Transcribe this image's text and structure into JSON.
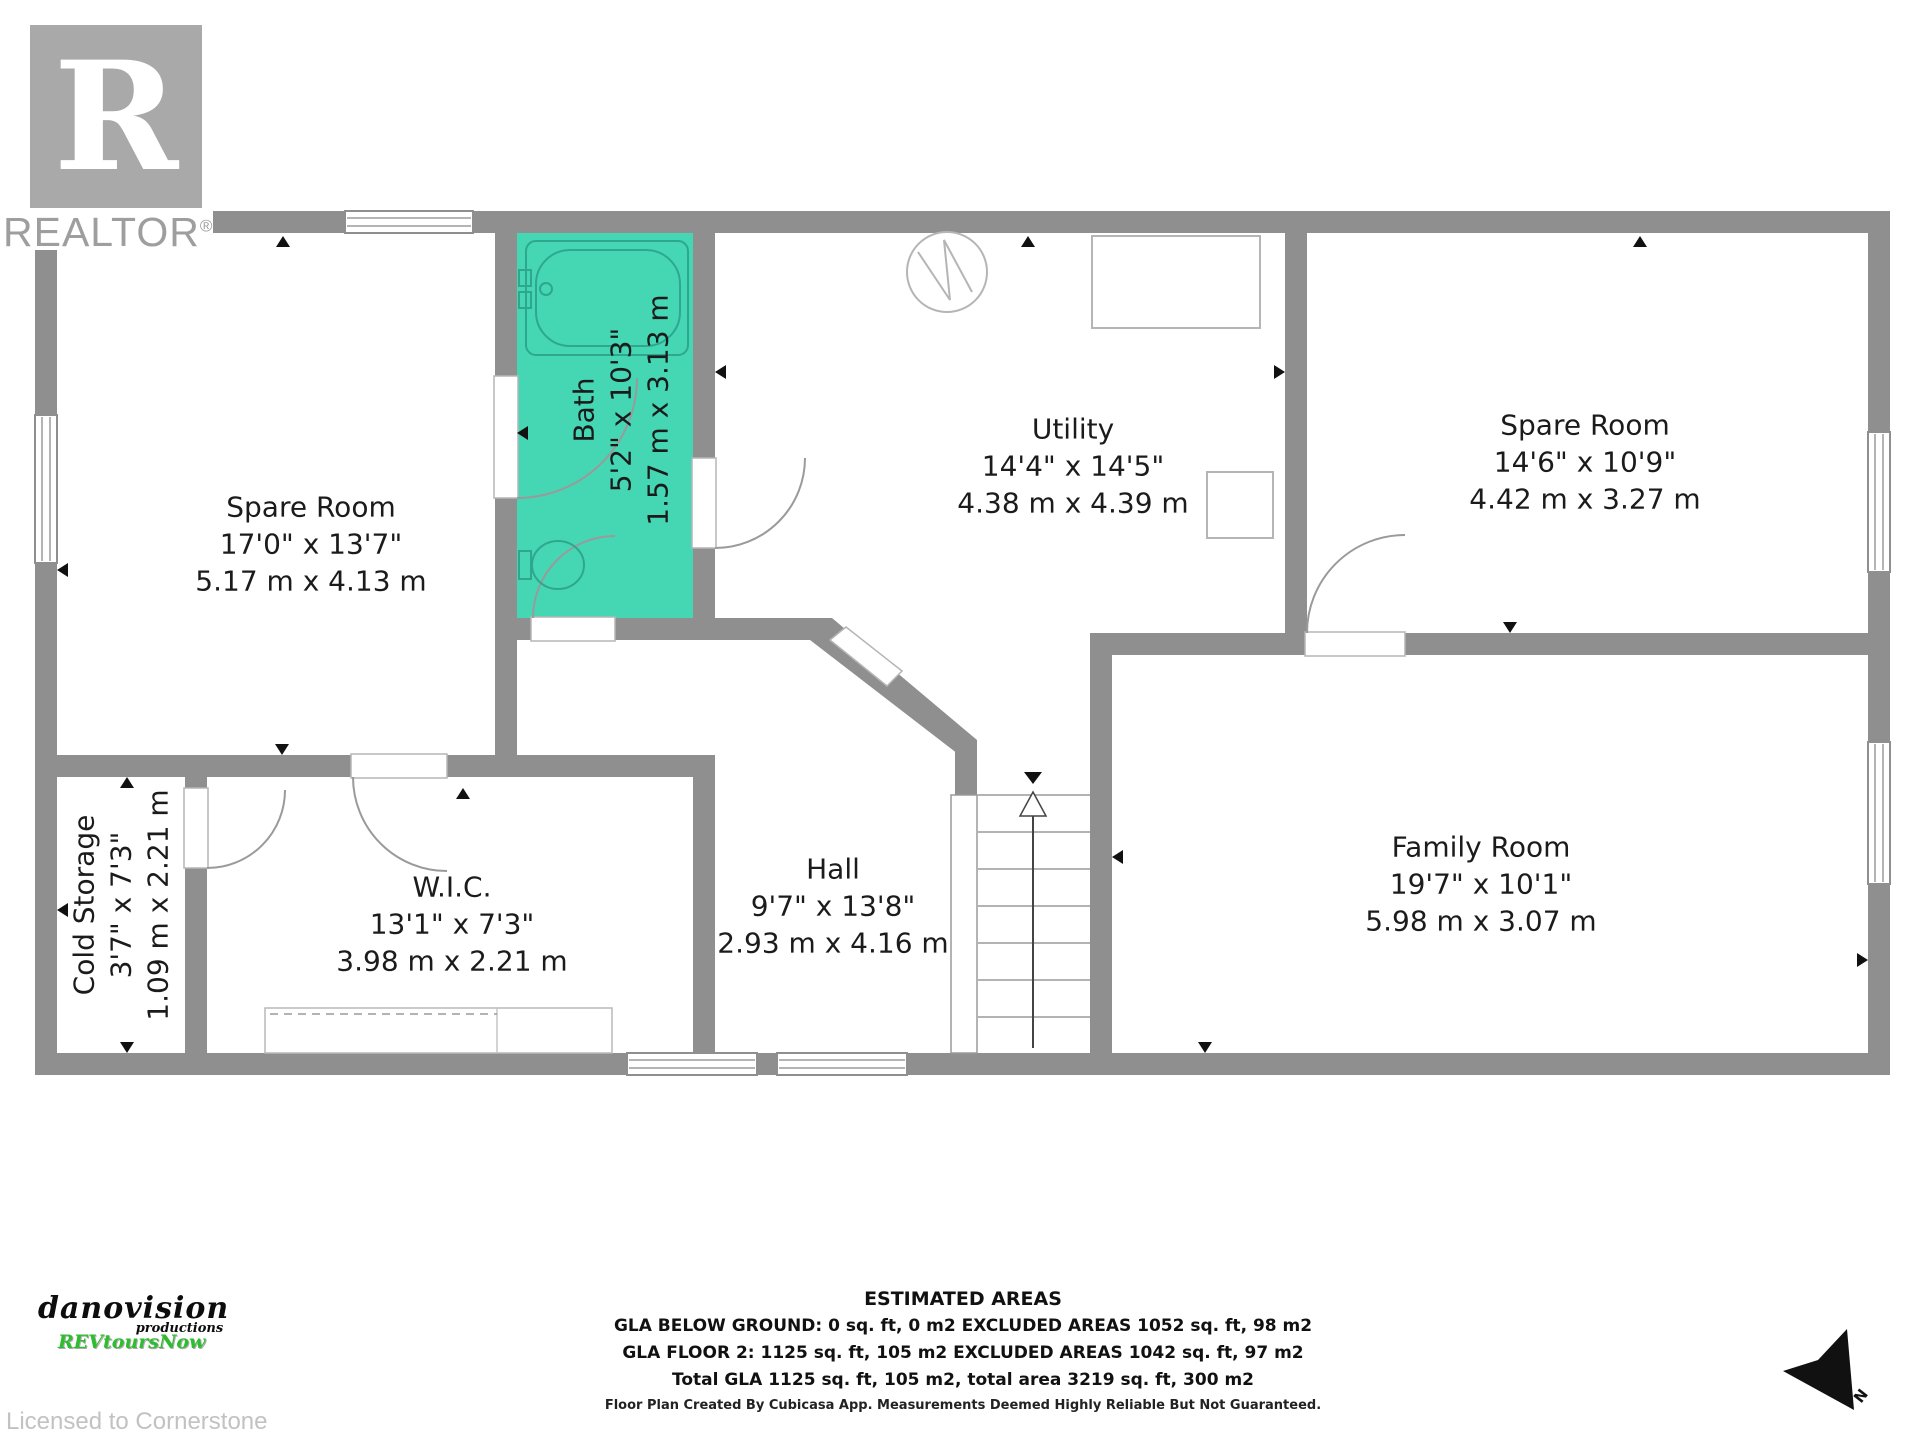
{
  "branding": {
    "logo_letter": "R",
    "realtor_text": "REALTOR",
    "reg_mark": "®",
    "producer_line1": "danovision",
    "producer_line2": "productions",
    "producer_line3": "REVtoursNow",
    "licensed_text": "Licensed to Cornerstone"
  },
  "colors": {
    "wall_grey": "#8f8f8f",
    "bath_teal": "#45d6b4",
    "logo_grey": "#a9a9a9",
    "producer_green": "#2ebd2e",
    "text_black": "#1b1b1b"
  },
  "rooms": [
    {
      "id": "spare-room-left",
      "name": "Spare Room",
      "imperial": "17'0\" x 13'7\"",
      "metric": "5.17 m x 4.13 m"
    },
    {
      "id": "bath",
      "name": "Bath",
      "imperial": "5'2\" x 10'3\"",
      "metric": "1.57 m x 3.13 m"
    },
    {
      "id": "utility",
      "name": "Utility",
      "imperial": "14'4\" x 14'5\"",
      "metric": "4.38 m x 4.39 m"
    },
    {
      "id": "spare-room-right",
      "name": "Spare Room",
      "imperial": "14'6\" x 10'9\"",
      "metric": "4.42 m x 3.27 m"
    },
    {
      "id": "cold-storage",
      "name": "Cold Storage",
      "imperial": "3'7\" x 7'3\"",
      "metric": "1.09 m x 2.21 m"
    },
    {
      "id": "wic",
      "name": "W.I.C.",
      "imperial": "13'1\" x 7'3\"",
      "metric": "3.98 m x 2.21 m"
    },
    {
      "id": "hall",
      "name": "Hall",
      "imperial": "9'7\" x 13'8\"",
      "metric": "2.93 m x 4.16 m"
    },
    {
      "id": "family-room",
      "name": "Family Room",
      "imperial": "19'7\" x 10'1\"",
      "metric": "5.98 m x 3.07 m"
    }
  ],
  "estimated_areas": {
    "title": "ESTIMATED AREAS",
    "line1": "GLA BELOW GROUND: 0 sq. ft, 0 m2 EXCLUDED AREAS 1052 sq. ft, 98 m2",
    "line2": "GLA FLOOR 2: 1125 sq. ft, 105 m2 EXCLUDED AREAS 1042 sq. ft, 97 m2",
    "line3": "Total GLA 1125 sq. ft, 105 m2, total area 3219 sq. ft, 300 m2",
    "disclaimer": "Floor Plan Created By Cubicasa App. Measurements Deemed Highly Reliable But Not Guaranteed."
  },
  "compass": {
    "label": "N"
  }
}
